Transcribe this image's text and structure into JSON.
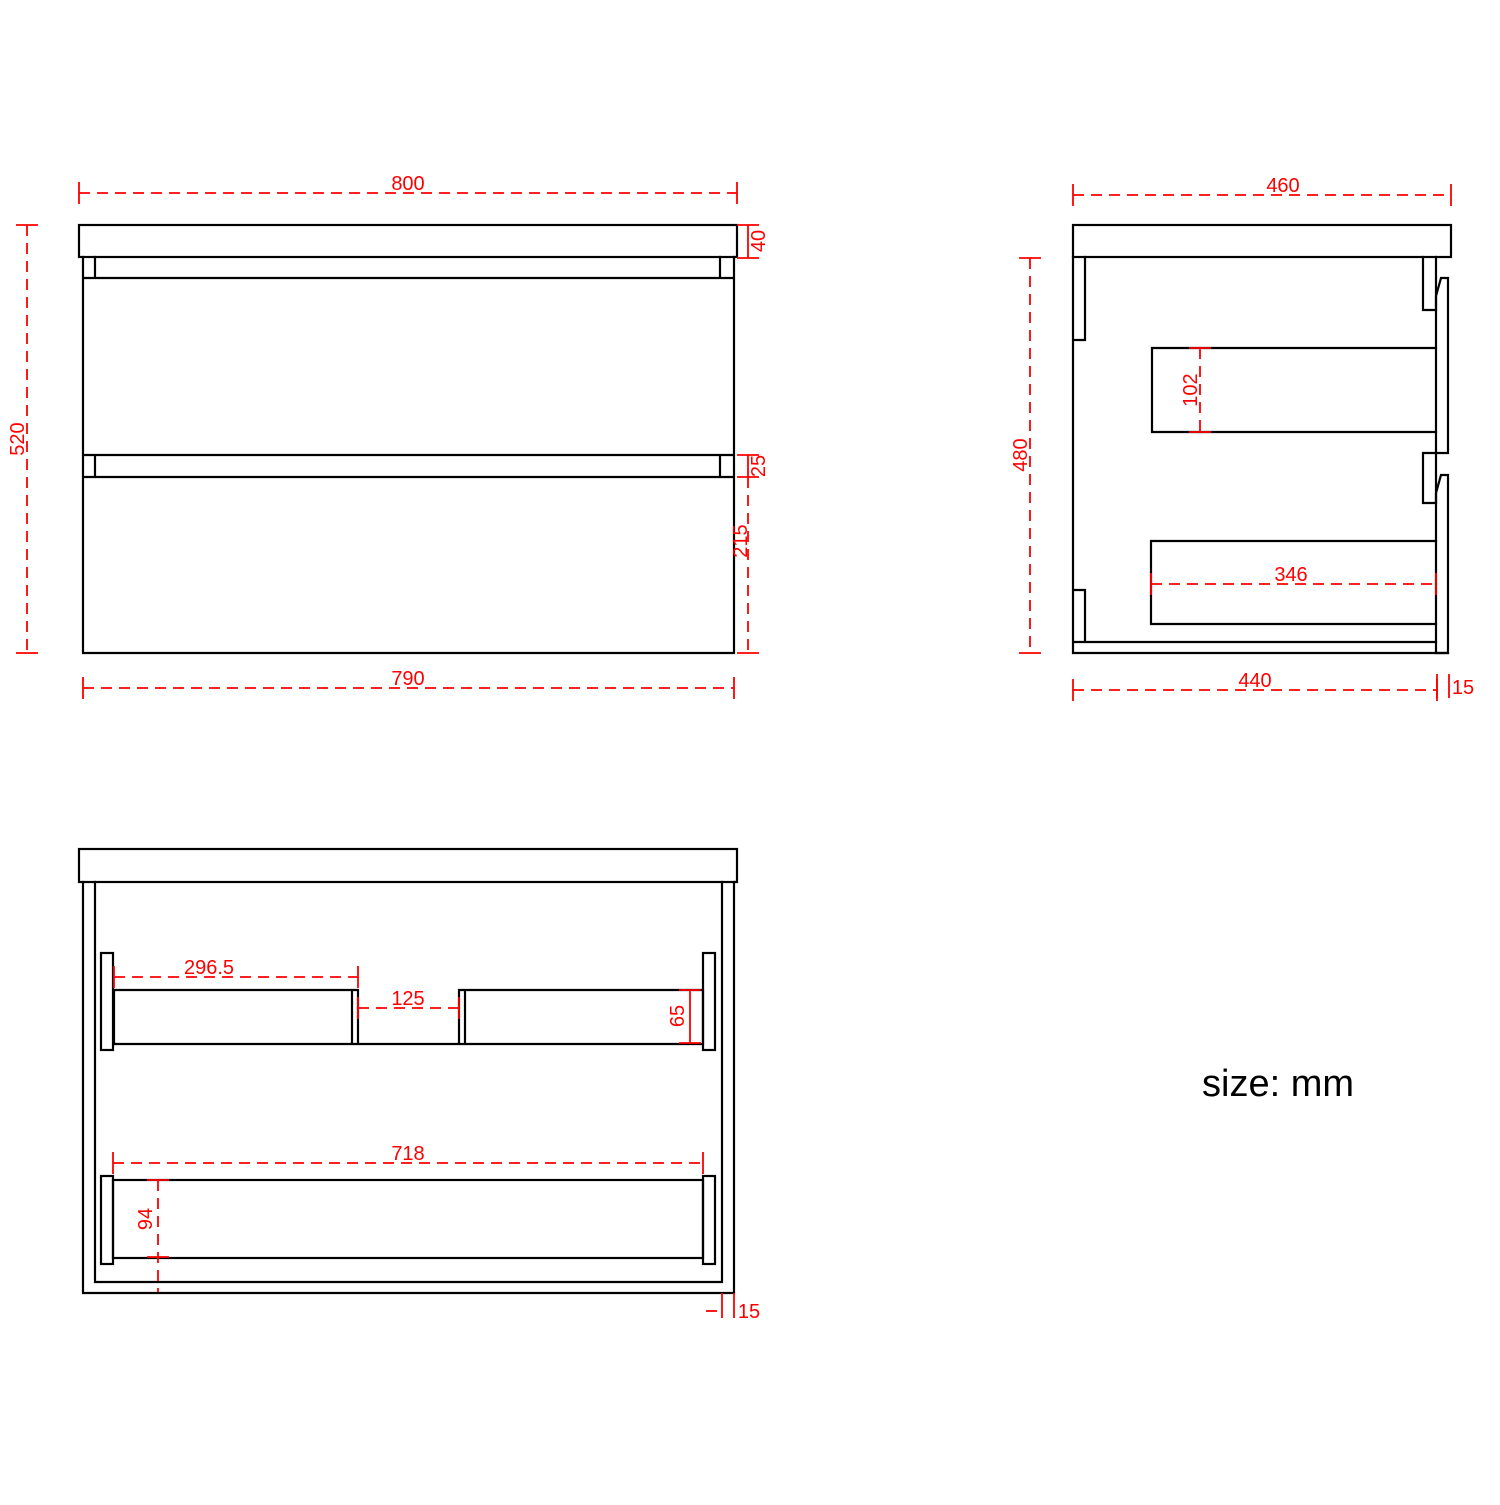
{
  "note": "size: mm",
  "unit": "mm",
  "colors": {
    "dimension": "#ff0000",
    "line": "#000000",
    "background": "#ffffff"
  },
  "views": {
    "front": {
      "label": "front view",
      "dims": {
        "overall_width": "800",
        "overall_height": "520",
        "top_thickness": "40",
        "drawer_gap": "25",
        "lower_drawer_height": "215",
        "cabinet_width": "790"
      }
    },
    "side": {
      "label": "side view",
      "dims": {
        "top_depth": "460",
        "cabinet_height": "480",
        "drawer_box_side_height": "102",
        "drawer_box_depth": "346",
        "cabinet_depth": "440",
        "front_panel_thickness": "15"
      }
    },
    "bottom": {
      "label": "bottom section view",
      "dims": {
        "left_back_rail_width": "296.5",
        "plumbing_gap": "125",
        "back_rail_depth": "65",
        "lower_back_rail_width": "718",
        "lower_back_rail_depth": "94",
        "panel_thickness": "15"
      }
    }
  }
}
